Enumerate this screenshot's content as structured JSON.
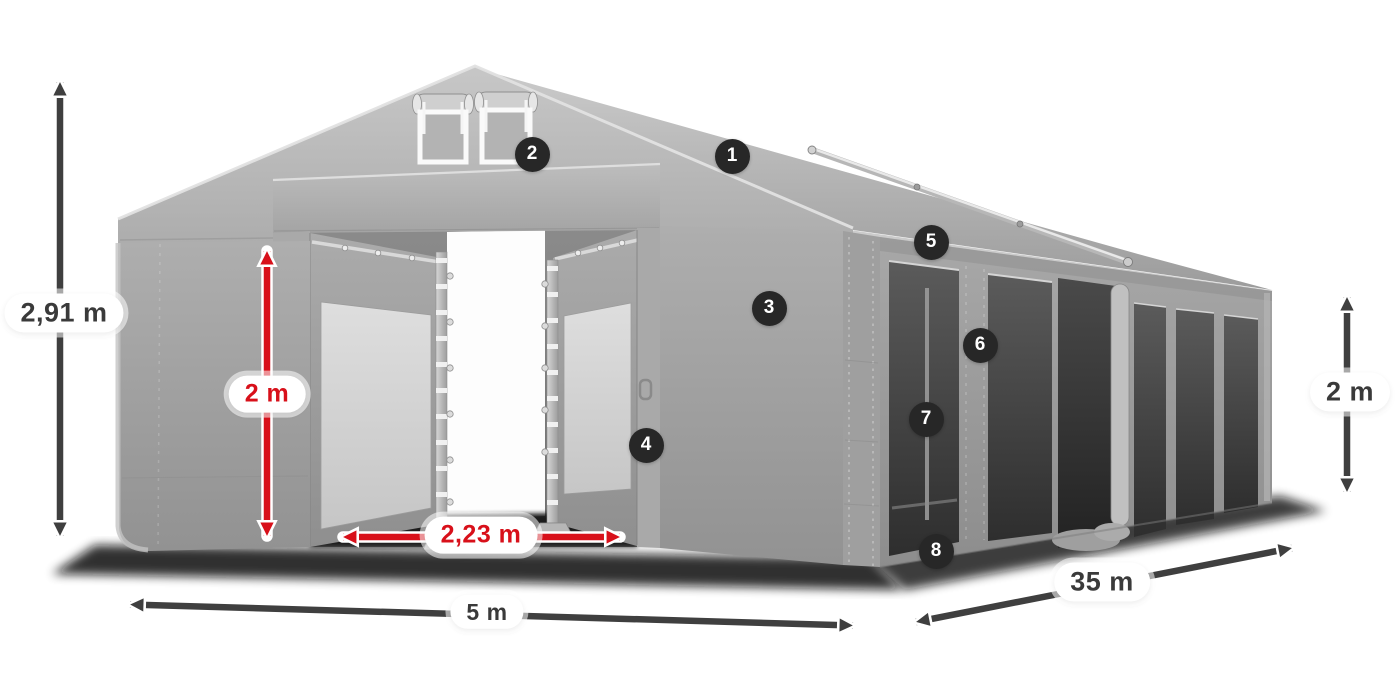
{
  "diagram": {
    "dimensions": {
      "total_height": {
        "label": "2,91 m",
        "style": "dark"
      },
      "entrance_height": {
        "label": "2 m",
        "style": "red"
      },
      "entrance_width": {
        "label": "2,23 m",
        "style": "red"
      },
      "width": {
        "label": "5 m",
        "style": "dark"
      },
      "length": {
        "label": "35 m",
        "style": "dark"
      },
      "side_height": {
        "label": "2 m",
        "style": "dark"
      }
    },
    "markers": [
      {
        "number": "1"
      },
      {
        "number": "2"
      },
      {
        "number": "3"
      },
      {
        "number": "4"
      },
      {
        "number": "5"
      },
      {
        "number": "6"
      },
      {
        "number": "7"
      },
      {
        "number": "8"
      }
    ],
    "colors": {
      "dimension_red": "#d8101a",
      "dimension_dark": "#3f3f3f",
      "marker_background": "#272727",
      "tent_gray": "#a7a7a7",
      "window_dark": "#3e3e3e"
    }
  }
}
